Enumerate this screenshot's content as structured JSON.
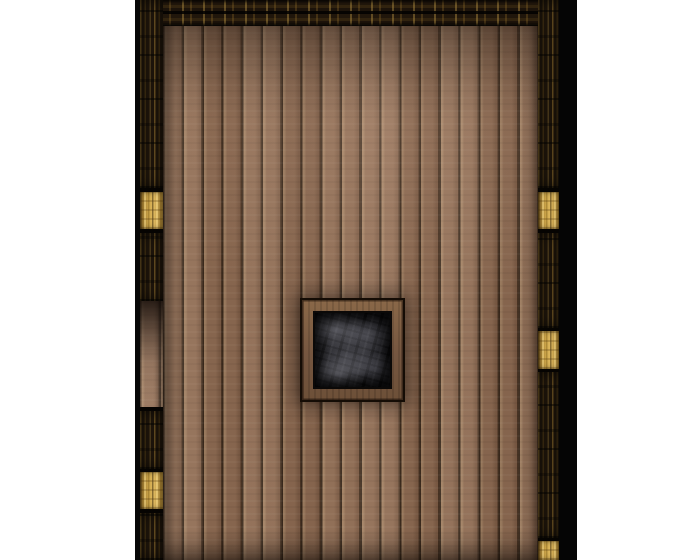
{
  "scene": {
    "type": "tabletop-battle-map-tile",
    "description": "Top-down dungeon room: vertical wooden plank floor bordered by dark timber walls with golden door segments, a doorway opening in the left wall, and a central square trapdoor revealing dark rock below.",
    "visible_text": "none",
    "features": [
      "wood-plank-floor",
      "dark-timber-walls",
      "gold-door-segments",
      "left-wall-doorway-opening",
      "central-trapdoor-pit"
    ]
  },
  "canvas": {
    "width": 700,
    "height": 560
  },
  "map": {
    "outline_left": {
      "x": 135,
      "y": 0,
      "width": 5,
      "height": 560
    },
    "top_wall": {
      "x": 140,
      "y": 0,
      "width": 420,
      "height": 26
    },
    "floor": {
      "x": 163,
      "y": 0,
      "width": 375,
      "height": 560,
      "plank_count": 19,
      "plank_width": 19.74
    },
    "left_wall": {
      "rect": {
        "x": 140,
        "y": 0,
        "width": 23,
        "height": 560
      },
      "segments": [
        {
          "type": "wood",
          "from": 0,
          "to": 188
        },
        {
          "type": "gap",
          "from": 188,
          "to": 192
        },
        {
          "type": "gold-door",
          "from": 192,
          "to": 229
        },
        {
          "type": "gap",
          "from": 229,
          "to": 233
        },
        {
          "type": "wood",
          "from": 233,
          "to": 301
        },
        {
          "type": "opening",
          "from": 301,
          "to": 407
        },
        {
          "type": "gap",
          "from": 407,
          "to": 411
        },
        {
          "type": "wood",
          "from": 411,
          "to": 469
        },
        {
          "type": "gap",
          "from": 469,
          "to": 472
        },
        {
          "type": "gold-door",
          "from": 472,
          "to": 509
        },
        {
          "type": "gap",
          "from": 509,
          "to": 513
        },
        {
          "type": "wood",
          "from": 513,
          "to": 560
        }
      ]
    },
    "right_wall": {
      "rect": {
        "x": 538,
        "y": 0,
        "width": 21,
        "height": 560
      },
      "segments": [
        {
          "type": "wood",
          "from": 0,
          "to": 188
        },
        {
          "type": "gap",
          "from": 188,
          "to": 192
        },
        {
          "type": "gold-door",
          "from": 192,
          "to": 229
        },
        {
          "type": "gap",
          "from": 229,
          "to": 233
        },
        {
          "type": "wood",
          "from": 233,
          "to": 328
        },
        {
          "type": "gap",
          "from": 328,
          "to": 331
        },
        {
          "type": "gold-door",
          "from": 331,
          "to": 369
        },
        {
          "type": "gap",
          "from": 369,
          "to": 372
        },
        {
          "type": "wood",
          "from": 372,
          "to": 538
        },
        {
          "type": "gap",
          "from": 538,
          "to": 541
        },
        {
          "type": "gold-door",
          "from": 541,
          "to": 560
        }
      ]
    },
    "outer_shadow_right": {
      "x": 559,
      "y": 0,
      "width": 18,
      "height": 560
    },
    "trapdoor": {
      "x": 302,
      "y": 300,
      "width": 101,
      "height": 100,
      "frame_thickness": 11
    }
  },
  "colors": {
    "page_bg": "#ffffff",
    "outline": "#070707",
    "shadow_strip": "#050505",
    "wall_dark": "#1e150b",
    "wall_gold_streak": "#8a6a2a",
    "door_gold_light": "#e0ba60",
    "door_gold_dark": "#8a6826",
    "floor_base": "#8d6b53",
    "floor_light": "#a8876e",
    "floor_seam": "#3a2a1d",
    "pit_frame": "#7d5e43",
    "rock_base": "#222226",
    "rock_light": "#8f8f99"
  }
}
